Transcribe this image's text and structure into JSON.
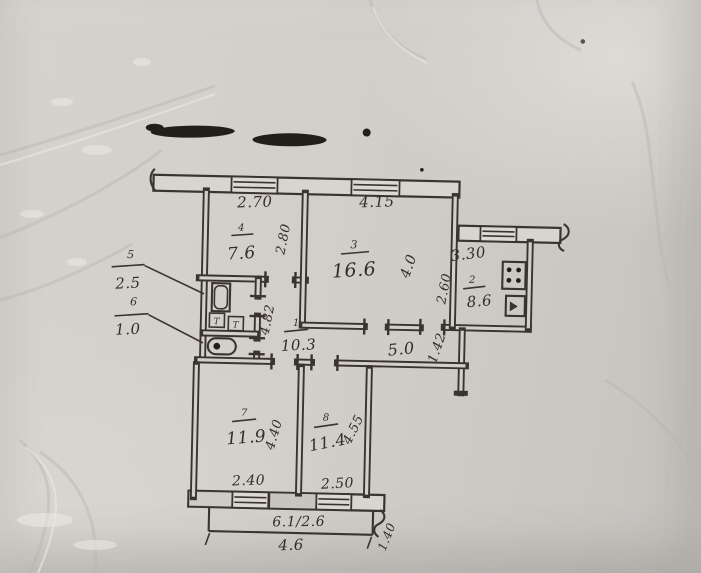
{
  "plan": {
    "rooms": {
      "hall": {
        "number": "1",
        "area": "10.3"
      },
      "kitchen": {
        "number": "2",
        "area": "8.6"
      },
      "living": {
        "number": "3",
        "area": "16.6"
      },
      "bedroom_top": {
        "number": "4",
        "area": "7.6"
      },
      "bathroom": {
        "number": "5",
        "area": "2.5"
      },
      "wc": {
        "number": "6",
        "area": "1.0"
      },
      "bedroom_left": {
        "number": "7",
        "area": "11.9"
      },
      "bedroom_right": {
        "number": "8",
        "area": "11.4"
      }
    },
    "dimensions": {
      "bedroom_top_width": "2.70",
      "living_width": "4.15",
      "kitchen_width": "3.30",
      "bedroom_top_depth": "2.80",
      "living_depth": "4.0",
      "kitchen_depth": "2.60",
      "hall_length": "5.0",
      "left_section_depth": "4.82",
      "hall_right_width": "1.42",
      "bedroom_left_depth": "4.40",
      "bedroom_left_window": "2.40",
      "bedroom_right_depth": "4.55",
      "bedroom_right_window": "2.50",
      "balcony_area": "6.1/2.6",
      "balcony_length": "4.6",
      "balcony_depth": "1.40"
    },
    "fixtures": {
      "towel_rail_1": "Т",
      "towel_rail_2": "Т"
    },
    "ink_color": "#3a342e",
    "paper_color": "#d3cfca"
  }
}
